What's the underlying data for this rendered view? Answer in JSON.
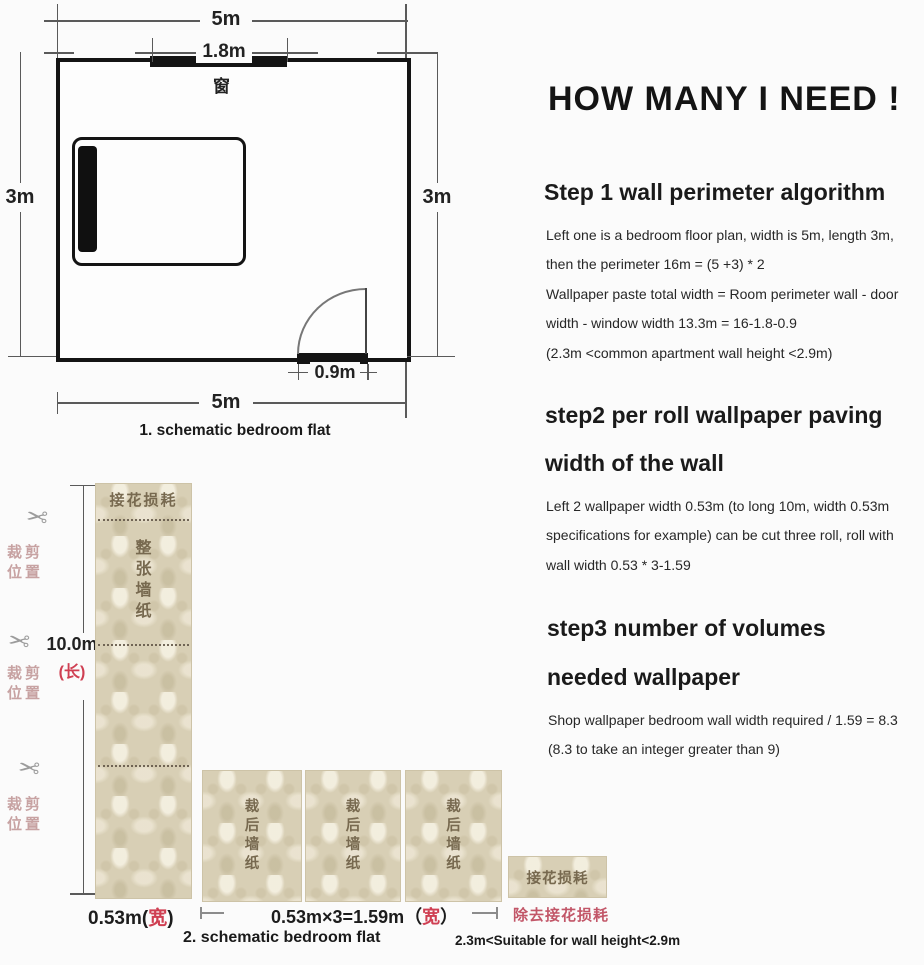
{
  "colors": {
    "accent_red": "#cf3f52",
    "rose_red": "#c25668",
    "pink_label": "#c7a2a2",
    "strip_text": "#77694f"
  },
  "icons": {
    "scissors_glyph": "✂"
  },
  "floor_plan": {
    "caption": "1. schematic bedroom flat",
    "top_width": "5m",
    "window_width": "1.8m",
    "window_label": "窗",
    "left_height": "3m",
    "right_height": "3m",
    "door_width": "0.9m",
    "bottom_width": "5m"
  },
  "roll_diagram": {
    "caption": "2. schematic bedroom flat",
    "length_value": "10.0m",
    "length_unit": "(长)",
    "cut_position_line1": "裁剪",
    "cut_position_line2": "位置",
    "top_waste_label": "接花损耗",
    "full_roll_label": "整张墙纸",
    "cut_roll_label": "裁后墙纸",
    "splice_waste_label": "接花损耗",
    "roll_width_prefix": "0.53m(",
    "roll_width_unit": "宽",
    "roll_width_suffix": ")",
    "total_width_prefix": "0.53m×3=1.59m（",
    "total_width_unit": "宽",
    "total_width_suffix": "）",
    "remove_waste_label": "除去接花损耗",
    "height_note": "2.3m<Suitable for wall height<2.9m"
  },
  "right_panel": {
    "title": "HOW MANY I NEED !",
    "step1": {
      "heading": "Step 1 wall perimeter algorithm",
      "lines": [
        "Left one is a bedroom floor plan, width is 5m, length 3m,",
        "then the perimeter 16m = (5 +3) * 2",
        "Wallpaper paste total width = Room perimeter wall - door",
        "width - window width 13.3m = 16-1.8-0.9",
        "(2.3m <common apartment wall height <2.9m)"
      ]
    },
    "step2": {
      "heading_line1": "step2 per roll wallpaper paving",
      "heading_line2": "width of the wall",
      "lines": [
        "Left 2 wallpaper width 0.53m (to long 10m, width 0.53m",
        "specifications for example) can be cut three roll, roll with",
        "wall width 0.53 * 3-1.59"
      ]
    },
    "step3": {
      "heading_line1": "step3 number of volumes",
      "heading_line2": "needed wallpaper",
      "lines": [
        "Shop wallpaper bedroom wall width required / 1.59 = 8.3",
        "(8.3 to take an integer greater than 9)"
      ]
    }
  }
}
